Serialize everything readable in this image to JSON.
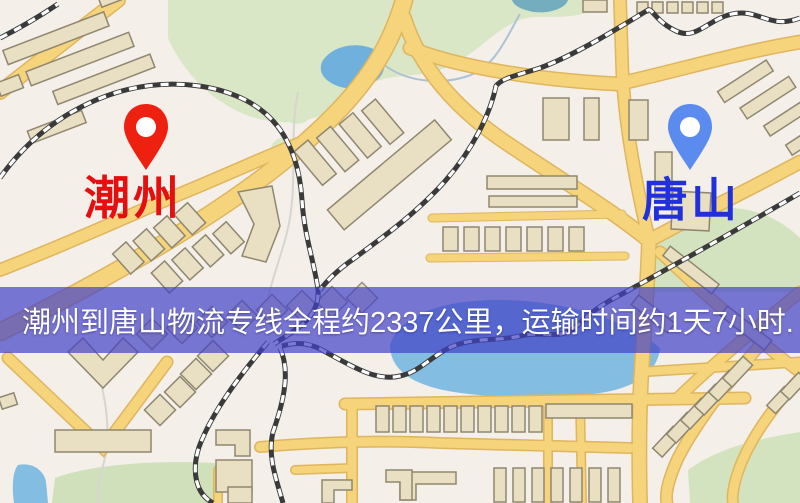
{
  "banner": {
    "text": "潮州到唐山物流专线全程约2337公里，运输时间约1天7小时.",
    "background_color": "#4242c8",
    "background_opacity": "0.70",
    "text_color": "#ffffff"
  },
  "route": {
    "origin": "潮州",
    "destination": "唐山",
    "distance_text": "约2337公里",
    "duration_text": "约1天7小时"
  },
  "markers": {
    "origin": {
      "label": "潮州",
      "icon": "map-pin-red",
      "pin_color": "#ee2010",
      "label_color": "#e60f0f"
    },
    "destination": {
      "label": "唐山",
      "icon": "map-pin-blue",
      "pin_color": "#5b8bee",
      "label_color": "#2130db"
    }
  },
  "map": {
    "palette": {
      "background": "#f4efe9",
      "road_fill": "#f5d47b",
      "road_casing": "#dfb55e",
      "building_fill": "#e9dfc2",
      "building_stroke": "#8f8770",
      "park_green": "#d9e7c6",
      "water_blue": "#6fb0dc",
      "railway_dark": "#3a3a3a",
      "railway_light": "#ffffff"
    }
  }
}
